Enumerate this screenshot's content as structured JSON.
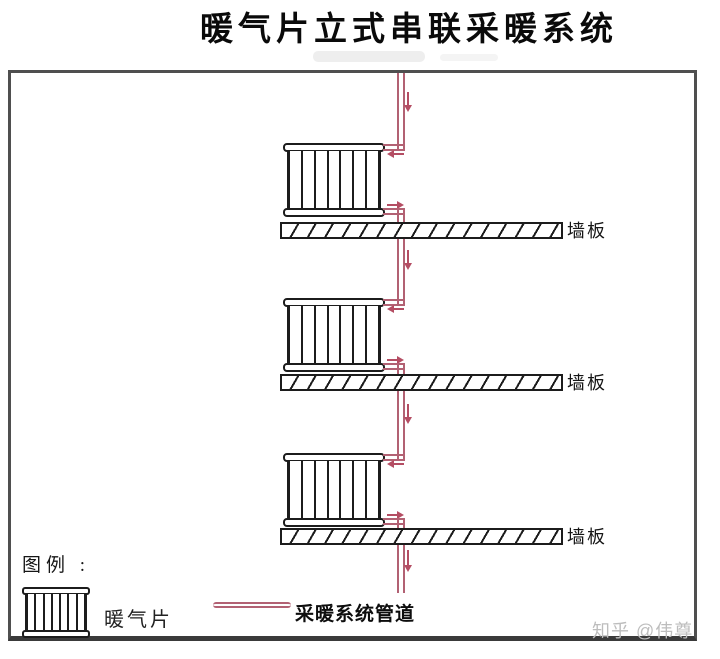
{
  "title": "暖气片立式串联采暖系统",
  "floors": [
    {
      "slab_label": "墙板"
    },
    {
      "slab_label": "墙板"
    },
    {
      "slab_label": "墙板"
    }
  ],
  "legend": {
    "heading": "图例 :",
    "radiator_label": "暖气片",
    "pipe_label": "采暖系统管道"
  },
  "watermark": "知乎 @伟尊",
  "radiator": {
    "columns": 7
  },
  "colors": {
    "pipe": "#b26173",
    "arrow": "#b44d63",
    "outline": "#1c1c1c",
    "border": "#4f4f4f",
    "watermark": "#bdbdbd",
    "title": "#0a0a0a"
  }
}
